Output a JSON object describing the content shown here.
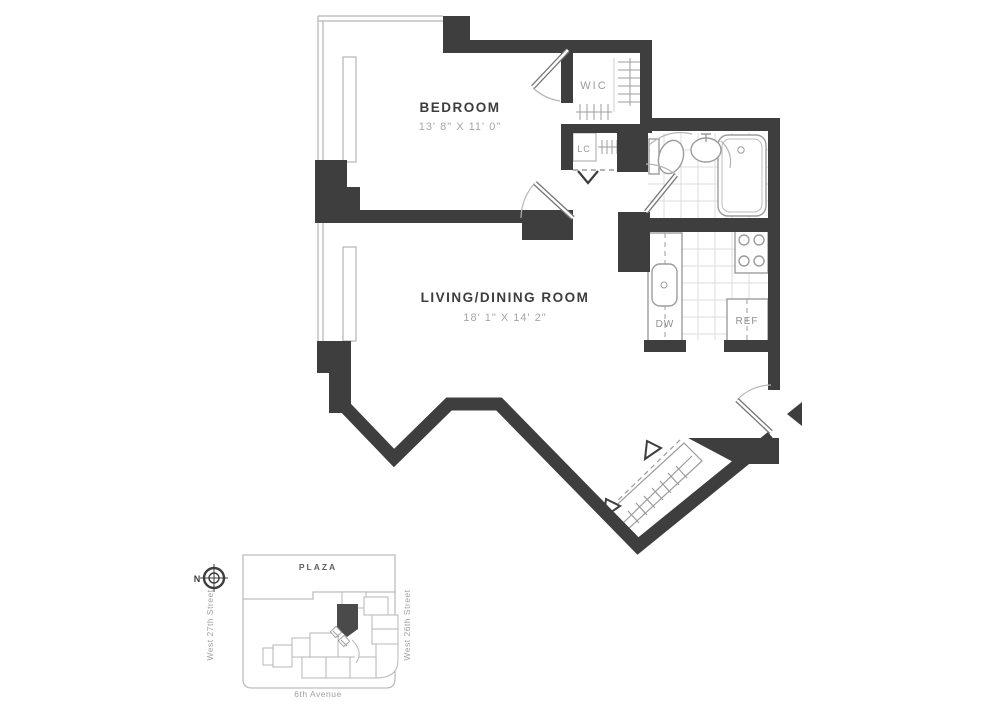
{
  "floor_plan": {
    "rooms": {
      "bedroom": {
        "name": "BEDROOM",
        "dimensions": "13' 8\" X 11' 0\""
      },
      "living": {
        "name": "LIVING/DINING ROOM",
        "dimensions": "18' 1\" X 14' 2\""
      },
      "walk_in_closet": {
        "label": "WIC"
      },
      "linen_closet": {
        "label": "LC"
      },
      "dishwasher": {
        "label": "DW"
      },
      "refrigerator": {
        "label": "REF"
      }
    },
    "colors": {
      "wall": "#3e3e3e",
      "fixture_line": "#9c9c9c",
      "light_line": "#b5b5b5",
      "tile_line": "#dcdcdc",
      "label_dark": "#3d3d3d",
      "label_dim": "#a6a6a6",
      "site_line": "#bdbdbd",
      "unit_highlight": "#4a4a4a"
    }
  },
  "site_plan": {
    "plaza_label": "PLAZA",
    "north_label": "N",
    "street_left": "West 27th Street",
    "street_right": "West 26th Street",
    "street_bottom": "6th Avenue"
  }
}
